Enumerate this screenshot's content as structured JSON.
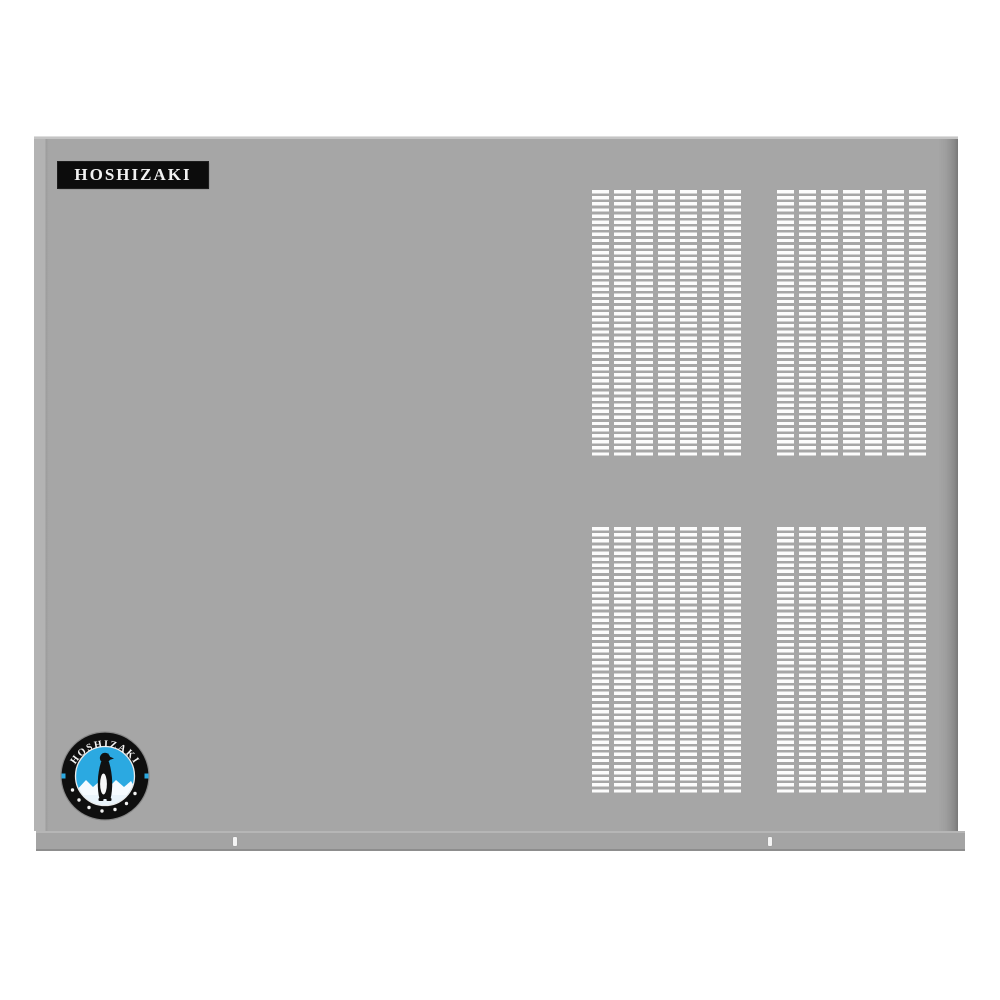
{
  "image": {
    "description": "Front panel of a Hoshizaki commercial ice machine on a white background",
    "background_color": "#ffffff"
  },
  "panel": {
    "body_color": "#a6a6a6",
    "left_edge_highlight": "#b3b3b3",
    "right_edge_shadow": "#787878",
    "top_edge_highlight": "#dedede"
  },
  "brand_badge": {
    "text": "HOSHIZAKI",
    "background_color": "#0c0c0c",
    "text_color": "#f2f2f2"
  },
  "logo": {
    "arc_text": "HOSHIZAKI",
    "ring_color": "#0f0f0f",
    "inner_circle_color": "#2ba9e1",
    "penguin_color": "#111111",
    "iceberg_color": "#f6fbff",
    "star_count": 7,
    "side_mark_color": "#2ba9e1"
  },
  "grilles": {
    "count": 4,
    "columns_per_grille": 7,
    "slot_color": "#fcfcfc",
    "positions": [
      "top-left",
      "top-right",
      "bottom-left",
      "bottom-right"
    ]
  },
  "kick_strip": {
    "color": "#a4a4a4",
    "rivet_count": 2,
    "rivet_color": "#f4f4f4"
  }
}
